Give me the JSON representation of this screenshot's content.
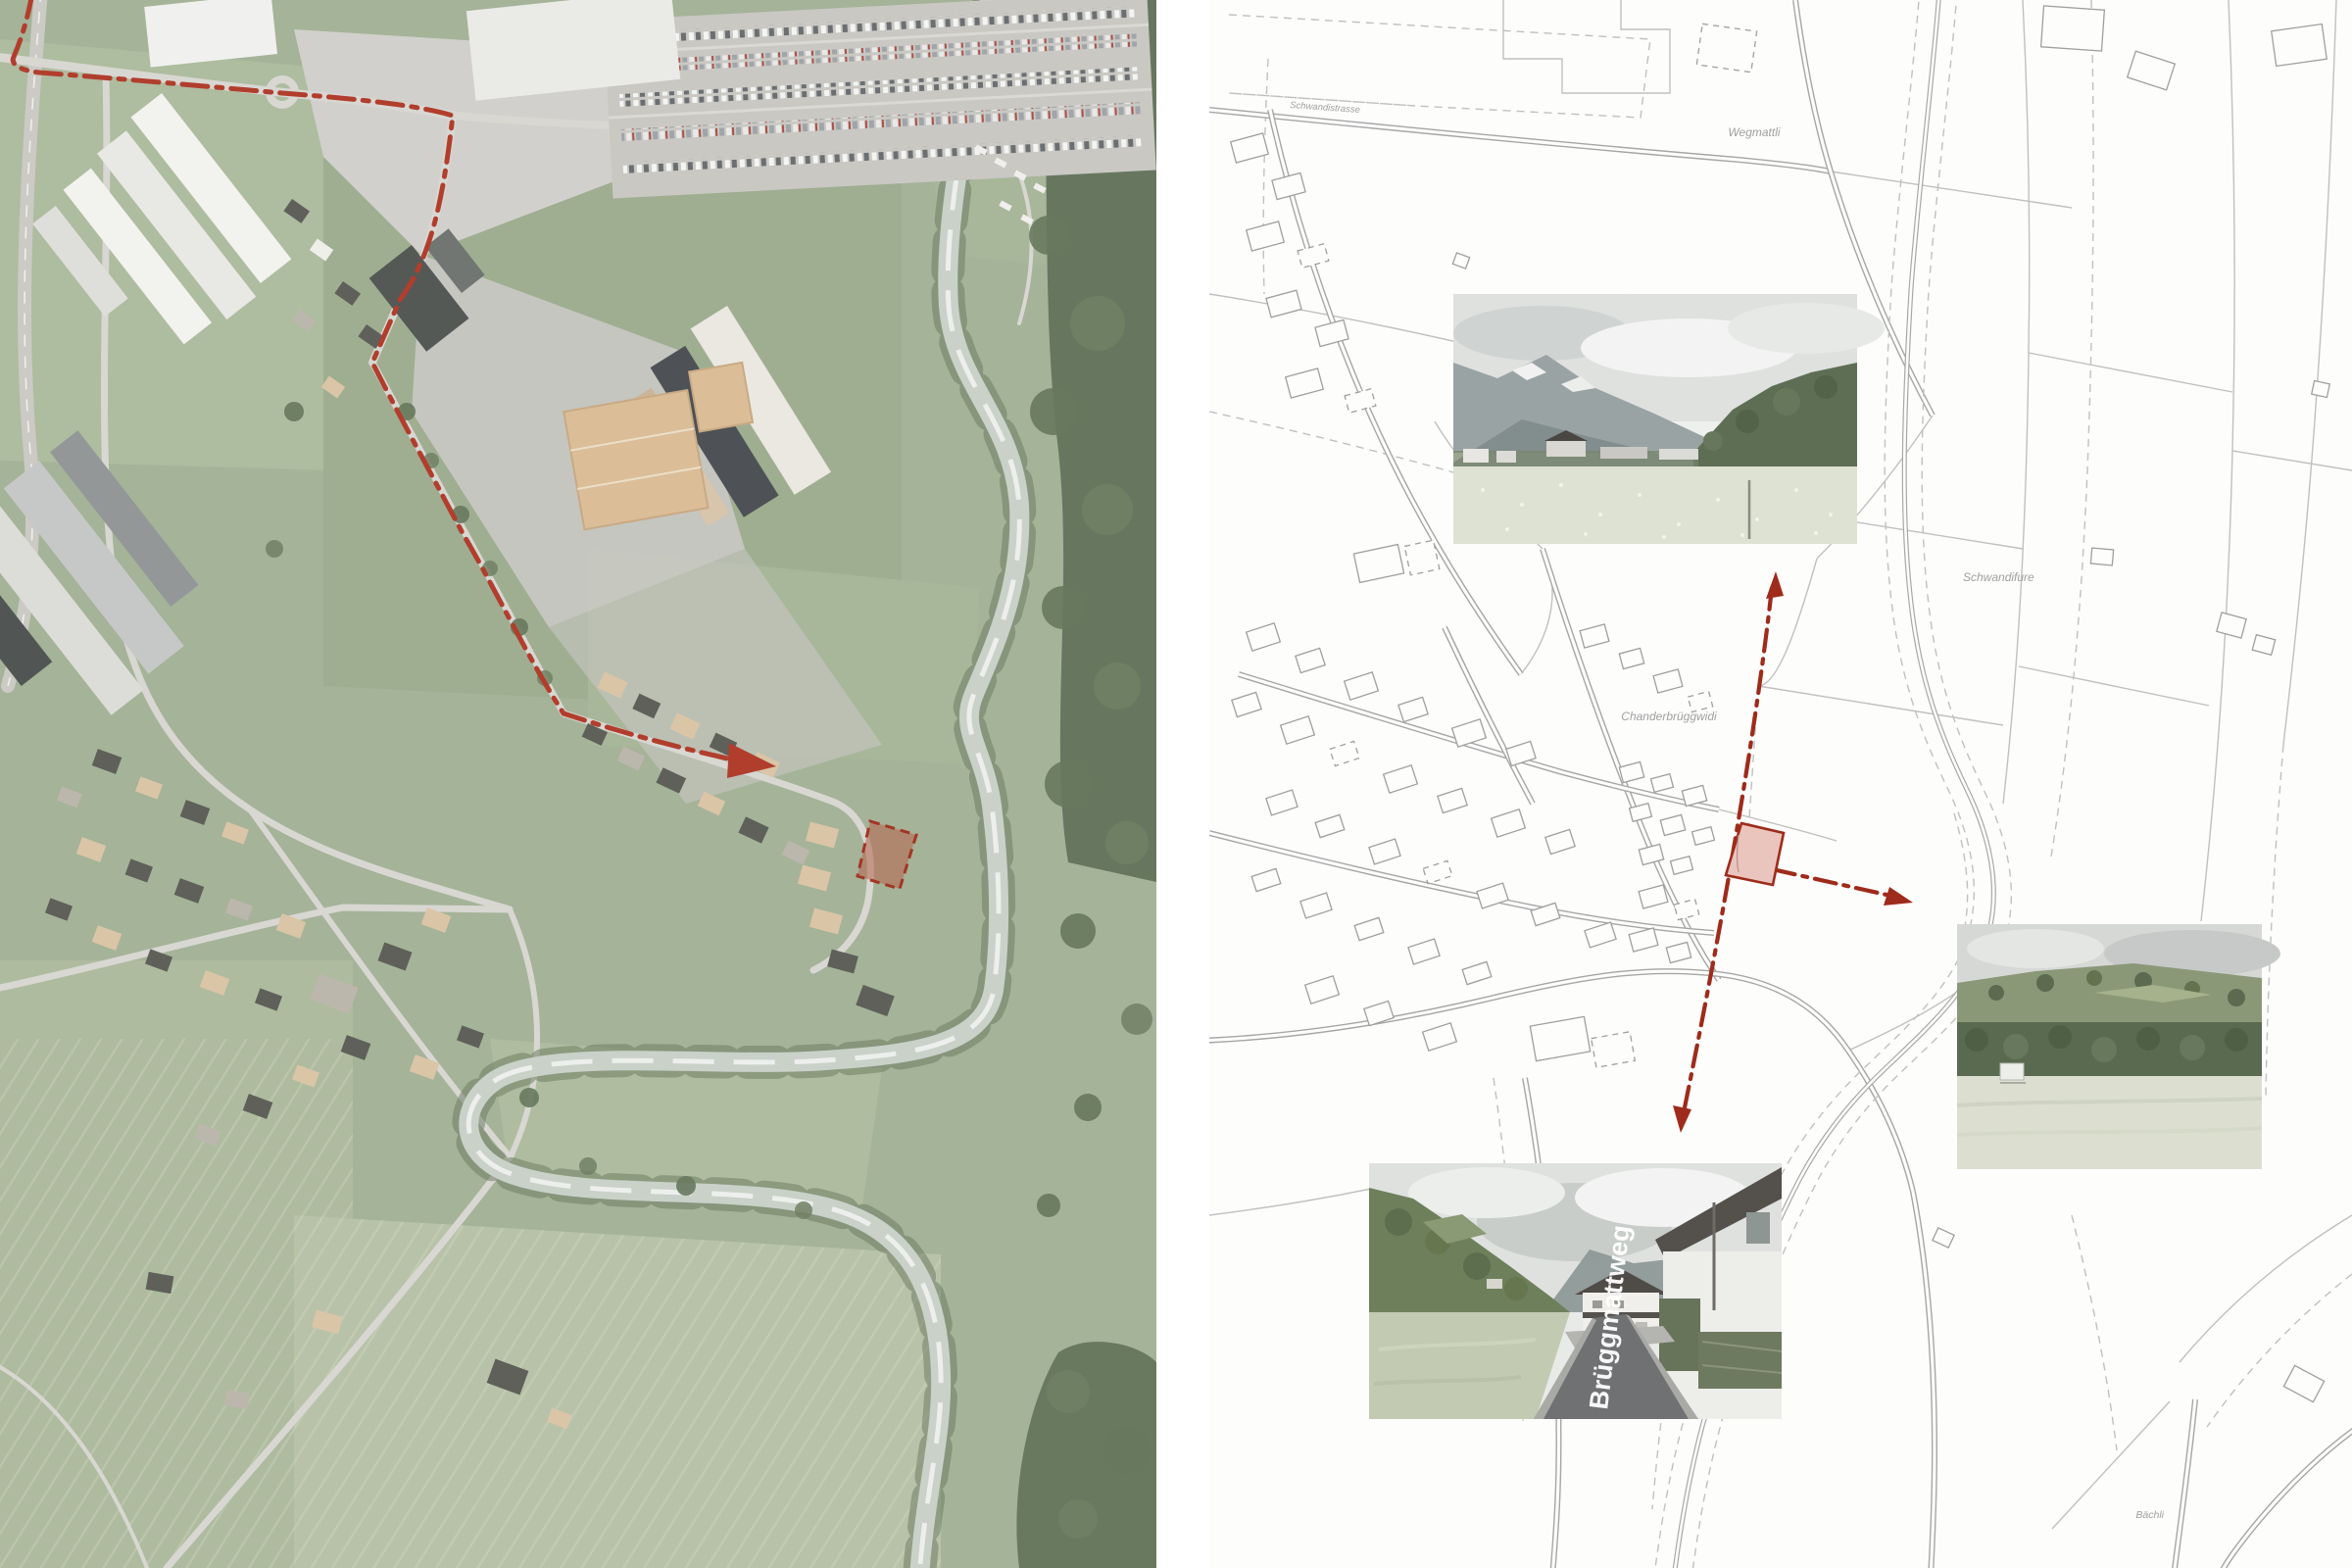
{
  "colors": {
    "accent_red": "#9e2b1b",
    "parcel_fill": "#eac5bd",
    "parcel_fill_aerial": "#b35a42",
    "map_line": "#c0c0c0",
    "road_line": "#a6a6a6",
    "aerial_green": "#a0af92",
    "forest_green": "#5e7054",
    "river_gray": "#c6cfc6"
  },
  "map": {
    "labels": {
      "wegmattli": "Wegmattli",
      "schwandistrasse": "Schwandistrasse",
      "schwandifure": "Schwandifure",
      "chanderbrueggwidi": "Chanderbrüggwidi",
      "baechli": "Bächli"
    }
  },
  "street_view": {
    "street_name": "Brüggmattweg"
  }
}
